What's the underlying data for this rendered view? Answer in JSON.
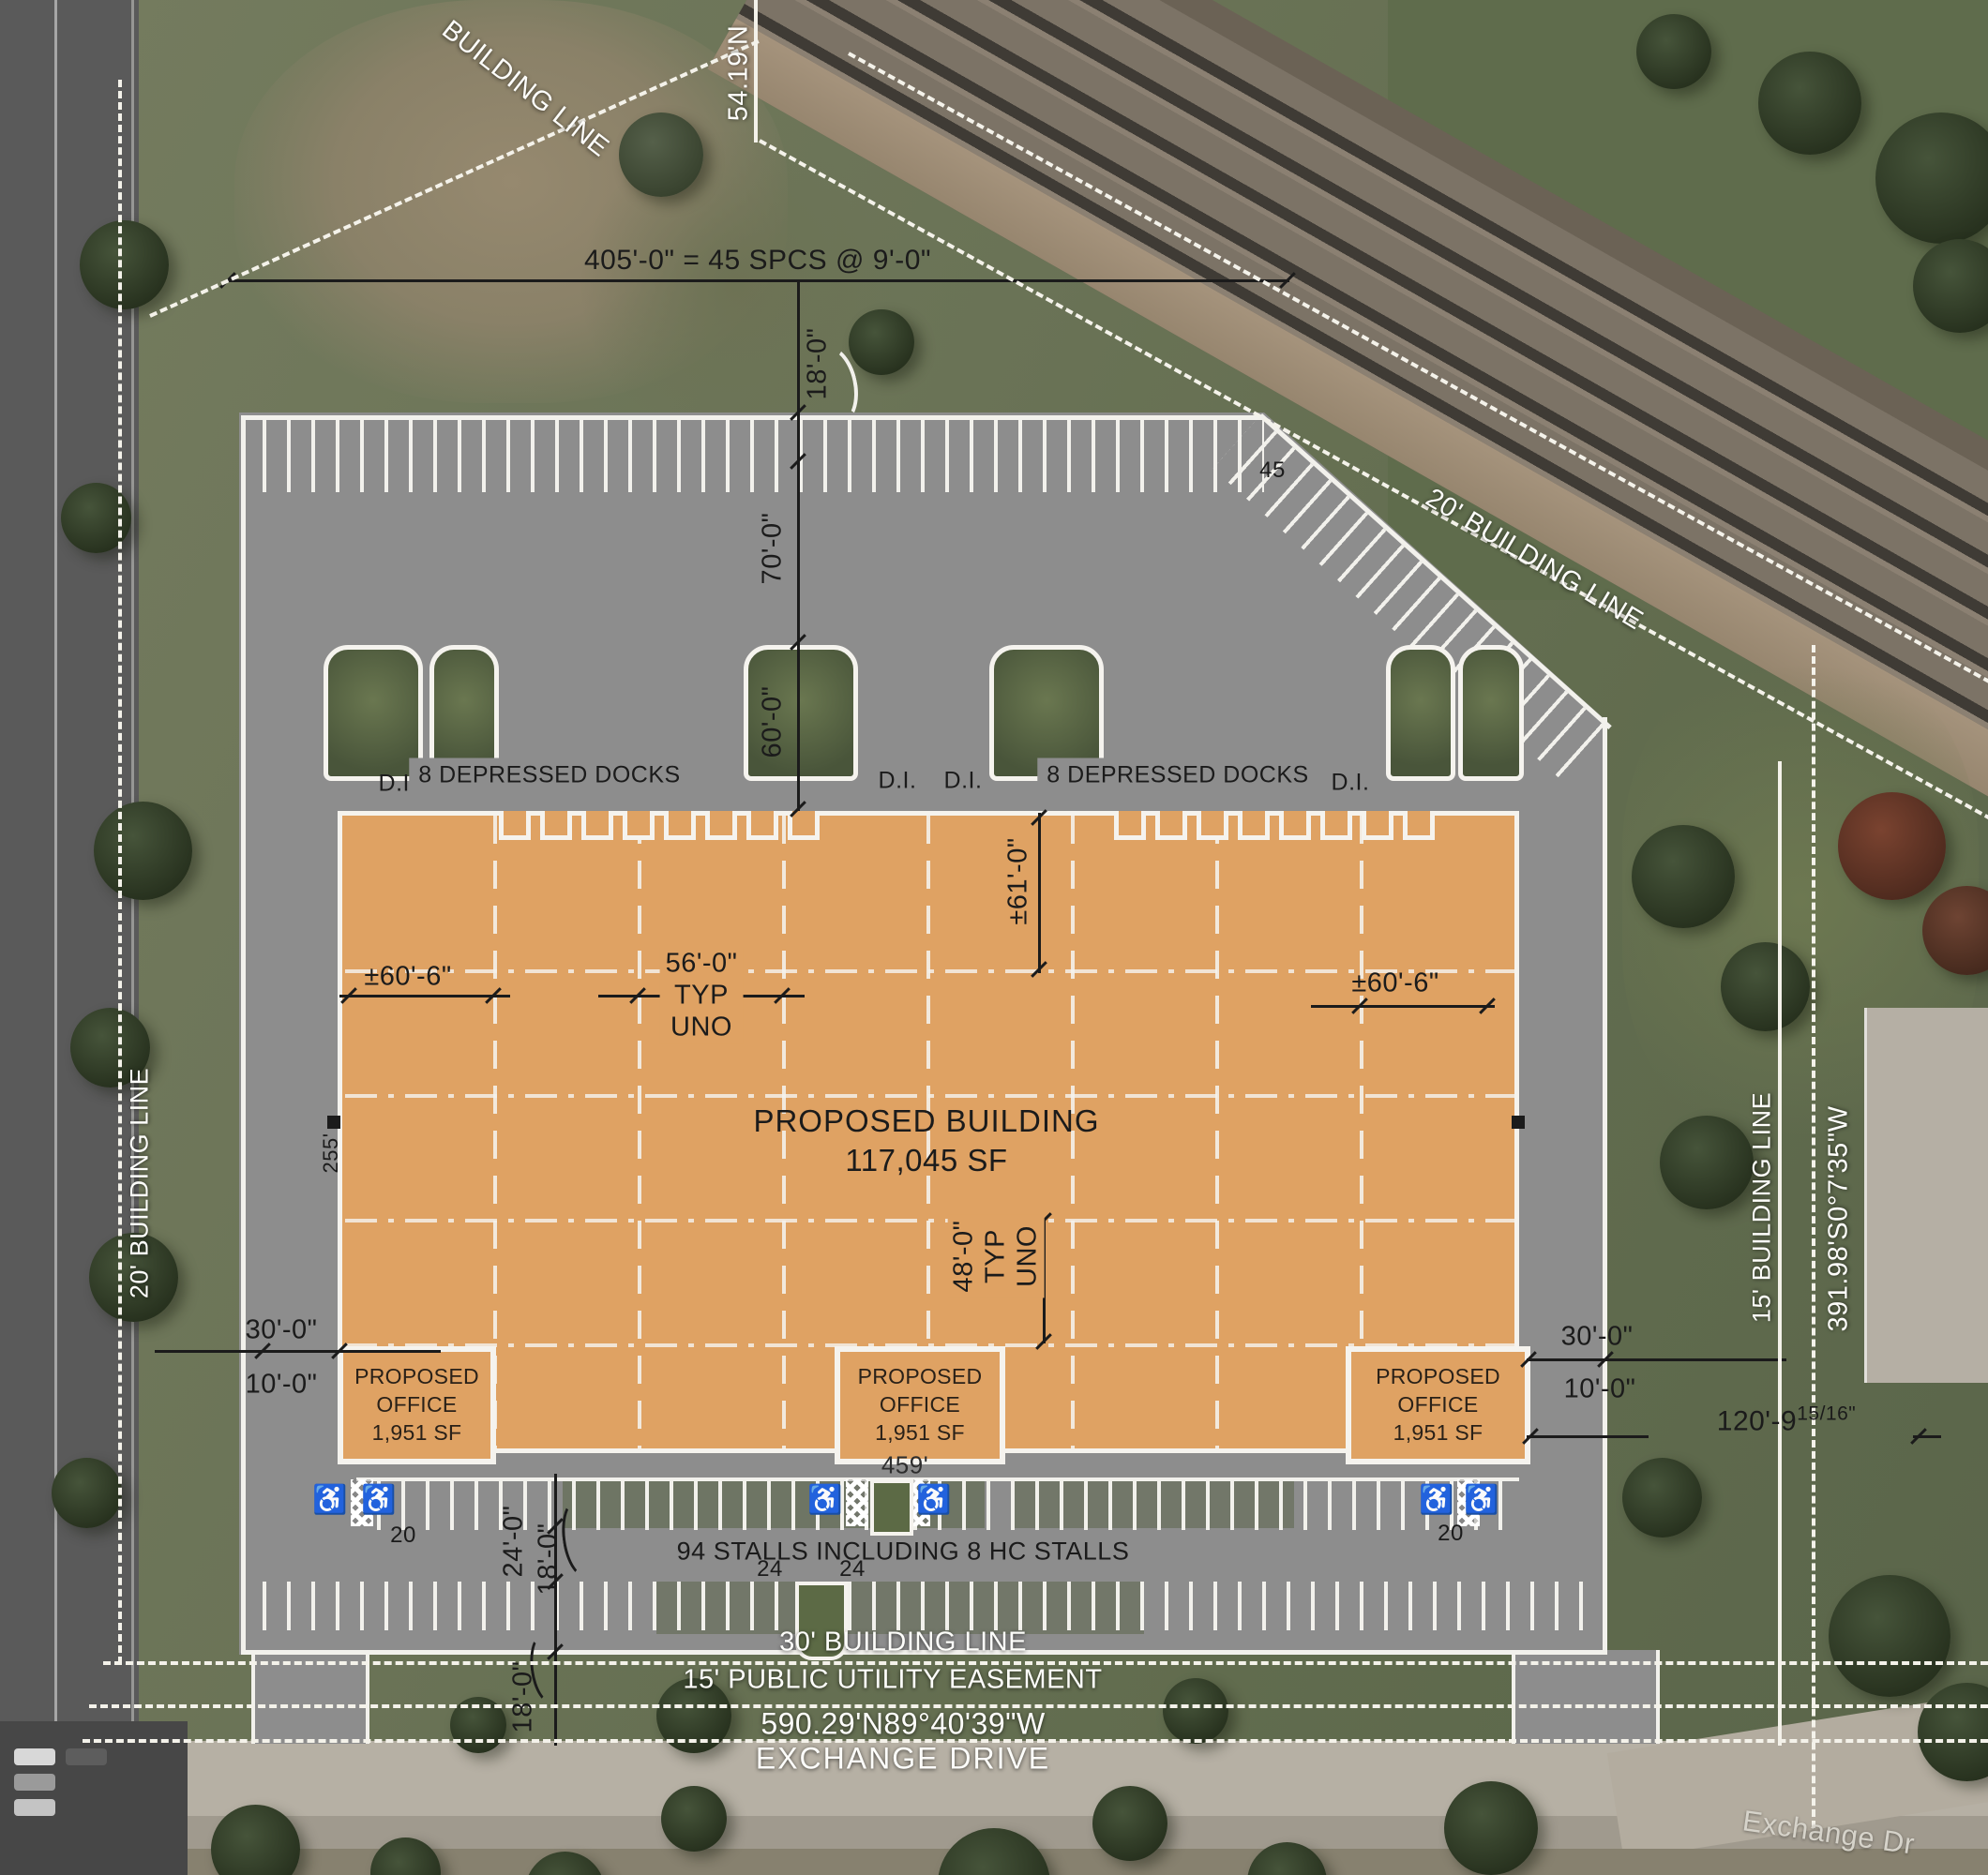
{
  "labels": {
    "top_spaces": "405'-0\" = 45 SPCS @ 9'-0\"",
    "dim18": "18'-0\"",
    "dim70": "70'-0\"",
    "dim60": "60'-0\"",
    "dim60_6": "±60'-6\"",
    "dim56": "56'-0\"",
    "typ": "TYP",
    "uno": "UNO",
    "dim61": "±61'-0\"",
    "dim48": "48'-0\"",
    "dim30": "30'-0\"",
    "dim10": "10'-0\"",
    "dim120_main": "120'-9",
    "dim120_frac": "15/16\"",
    "dim24": "24'-0\"",
    "building_name": "PROPOSED BUILDING",
    "building_area": "117,045 SF",
    "office_name": "PROPOSED OFFICE",
    "office_area": "1,951 SF",
    "docks_left": "8 DEPRESSED DOCKS",
    "docks_right": "8 DEPRESSED DOCKS",
    "di": "D.I.",
    "stalls_note": "94 STALLS INCLUDING 8 HC STALLS",
    "len459": "459'",
    "len255": "255'",
    "n45": "45",
    "n20": "20",
    "n24": "24",
    "building_line": "BUILDING LINE",
    "bearing_top": "54.19'N",
    "rail_building_line": "20' BUILDING LINE",
    "left_building_line": "20' BUILDING LINE",
    "right_building_line": "15' BUILDING LINE",
    "right_bearing": "391.98'S0°7'35\"W",
    "bottom_building_line": "30' BUILDING LINE",
    "utility_easement": "15' PUBLIC UTILITY EASEMENT",
    "bottom_bearing": "590.29'N89°40'39\"W",
    "street": "EXCHANGE DRIVE",
    "street_map": "Exchange Dr",
    "hc_symbol": "♿"
  },
  "colors": {
    "building_fill": "#dfa263",
    "pavement": "#8d8d8d",
    "stripe_white": "#f2f1ec",
    "annotation_black": "#1b1b1b",
    "annotation_white": "#ffffff"
  }
}
